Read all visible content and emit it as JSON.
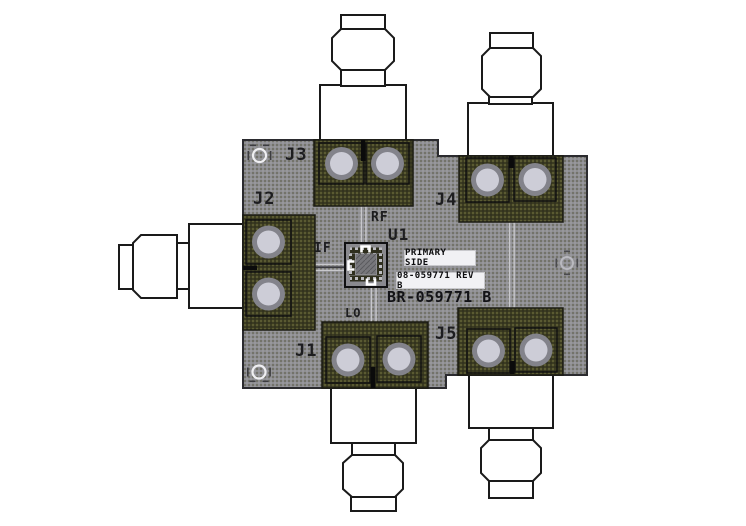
{
  "board": {
    "designators": {
      "j1": "J1",
      "j2": "J2",
      "j3": "J3",
      "j4": "J4",
      "j5": "J5",
      "u1": "U1"
    },
    "ports": {
      "rf": "RF",
      "if": "IF",
      "lo": "LO"
    },
    "part_number": "BR-059771 B",
    "stickers": {
      "primary_side": "PRIMARY SIDE",
      "rev": "08-059771 REV B"
    }
  },
  "colors": {
    "background": "#ffffff",
    "board_gray": "#8e8e92",
    "pad_olive": "#3c3c21",
    "via_ring": "#83838b",
    "via_fill": "#cdcdd7",
    "connector_fill": "#ffffff",
    "outline": "#1a1a1a",
    "silkscreen_text": "#1d1d20",
    "trace_light": "#c8c8cc"
  }
}
